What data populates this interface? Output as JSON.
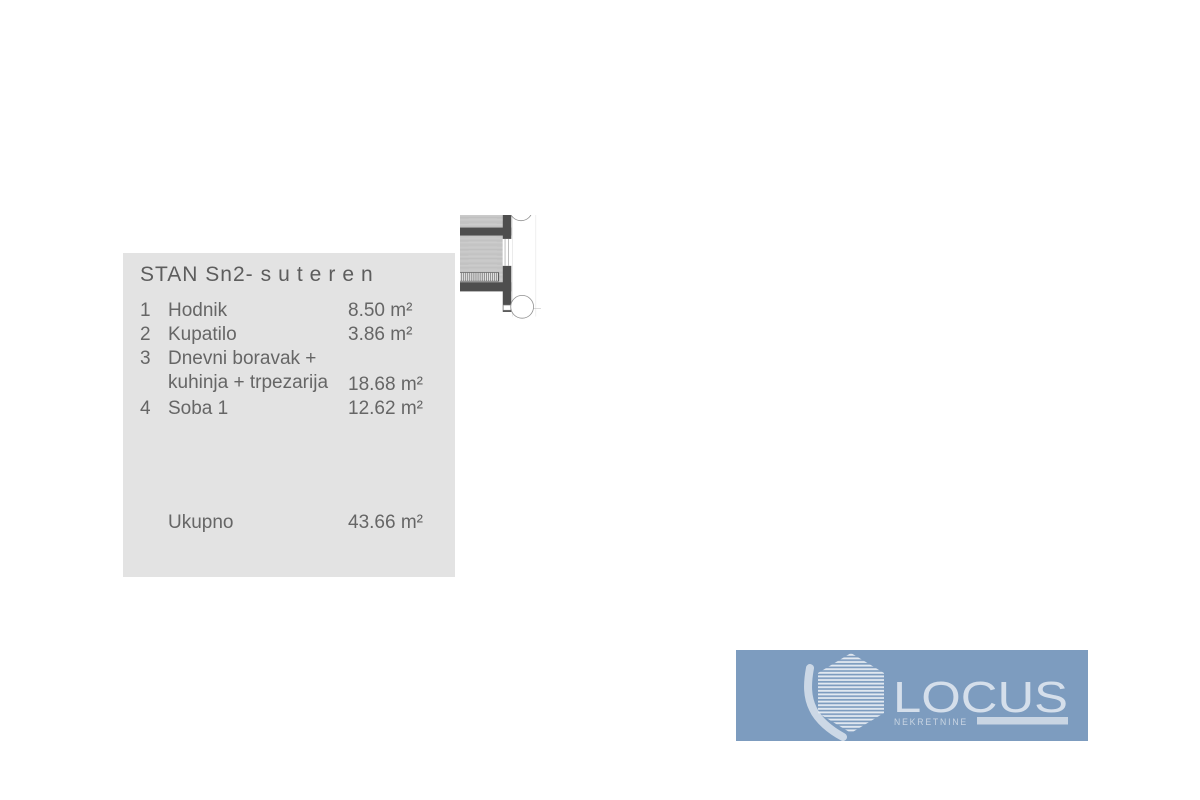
{
  "legend": {
    "title_prefix": "STAN Sn2-",
    "title_suffix": "suteren",
    "items": [
      {
        "num": "1",
        "line1": "Hodnik",
        "area": "8.50 m²"
      },
      {
        "num": "2",
        "line1": "Kupatilo",
        "area": "3.86 m²"
      },
      {
        "num": "3",
        "line1": "Dnevni boravak +",
        "line2": "kuhinja + trpezarija",
        "area": "18.68 m²"
      },
      {
        "num": "4",
        "line1": "Soba 1",
        "area": "12.62 m²"
      }
    ],
    "total_label": "Ukupno",
    "total_area": "43.66 m²"
  },
  "plan": {
    "room_numbers": {
      "hallway": "1",
      "bathroom": "2",
      "living": "3",
      "bedroom": "4"
    }
  },
  "logo": {
    "brand": "LOCUS",
    "tagline": "NEKRETNINE"
  },
  "colors": {
    "logo_bg": "#7d9cbf",
    "logo_fg": "#d5dfeb",
    "wall": "#4e4e4e",
    "panel_bg": "#e3e3e3",
    "text": "#666666"
  }
}
